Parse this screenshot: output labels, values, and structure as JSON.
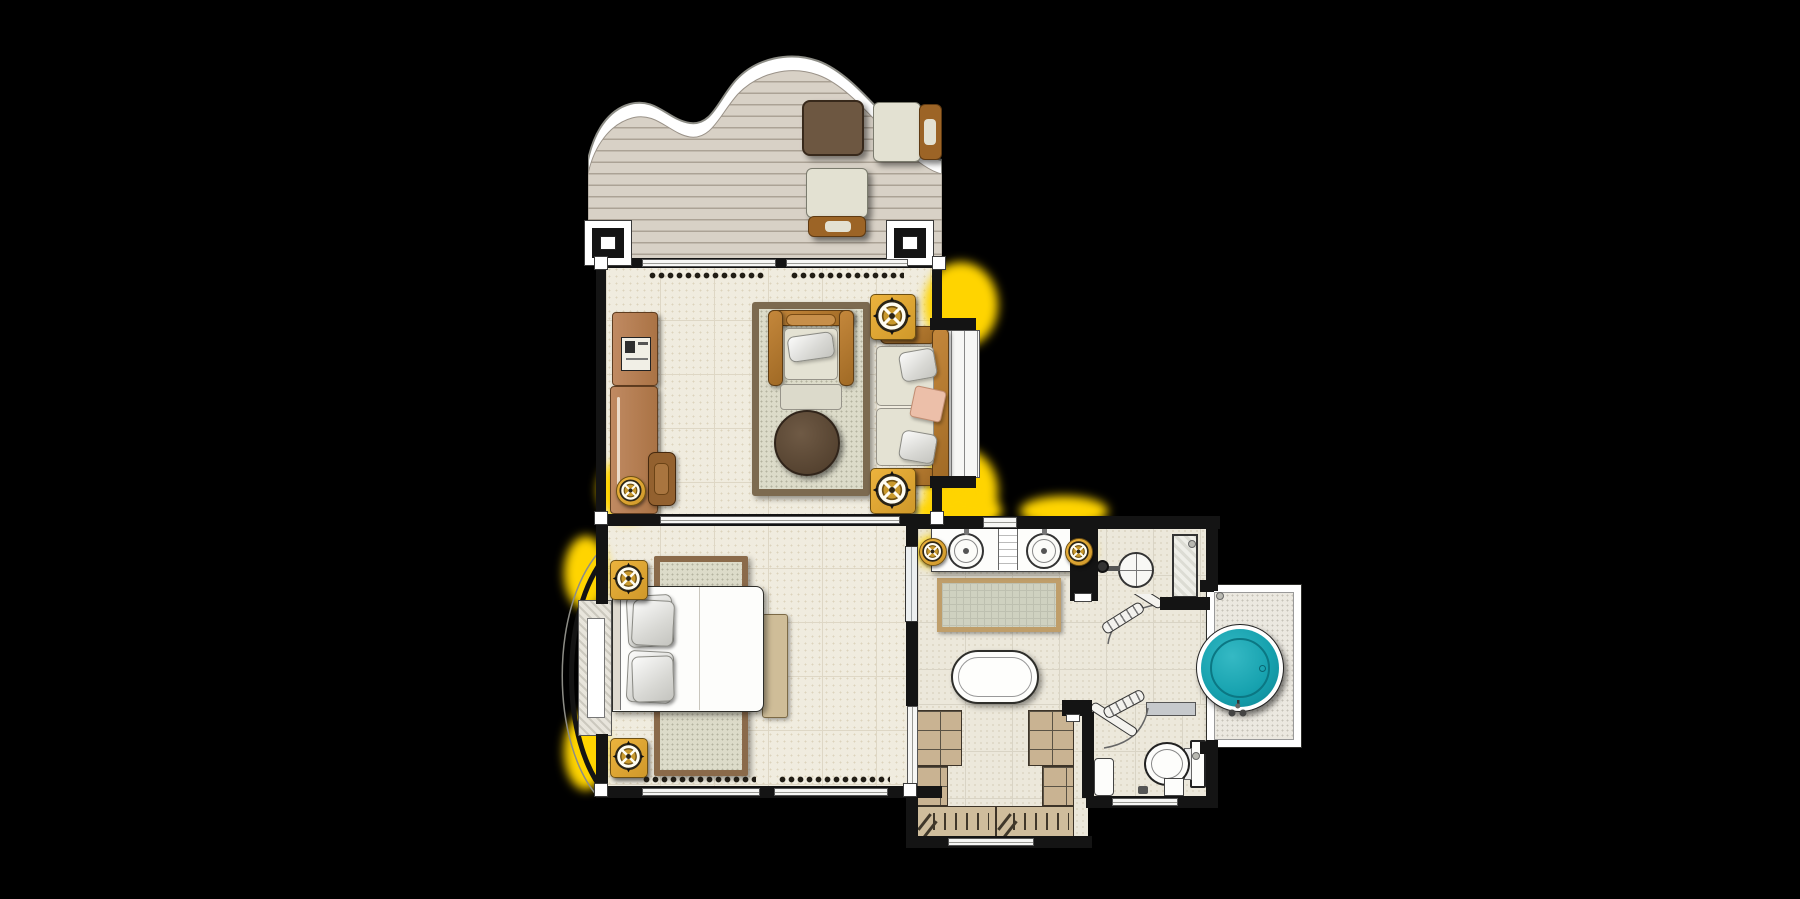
{
  "meta": {
    "kind": "floor-plan",
    "canvas": {
      "width": 1800,
      "height": 899
    }
  },
  "palette": {
    "background": "#000000",
    "wall": "#141414",
    "deck_wood": "#d8d1c6",
    "deck_line": "#aba295",
    "floor_cream": "#f0ecdf",
    "floor_bath": "#ece8db",
    "cabinet_brown": "#b5825d",
    "wood_frame": "#b0772f",
    "cushion_beige": "#e4e2d3",
    "pillow_pink": "#ecbfa9",
    "gold_accent": "#e2a930",
    "glow_yellow": "#ffd400",
    "rug_border_living": "#7c6a50",
    "rug_border_bed": "#8a6a4a",
    "rug_border_bath": "#bf9e6a",
    "coffee_table_brown": "#5f4b38",
    "wardrobe_tan": "#c9b392",
    "pool_teal": "#17a2af",
    "pool_teal_dark": "#0e8694",
    "fixture_white": "#fdfdfb"
  },
  "rooms": [
    {
      "name": "sun-deck"
    },
    {
      "name": "living-room"
    },
    {
      "name": "bedroom"
    },
    {
      "name": "bathroom"
    },
    {
      "name": "dressing-area"
    },
    {
      "name": "wc"
    },
    {
      "name": "plunge-pool-deck"
    }
  ],
  "fixtures": {
    "sun_deck": [
      "deck-table",
      "sun-lounger",
      "sun-lounger",
      "column",
      "column"
    ],
    "living_room": [
      "minibar-cabinet",
      "console-table",
      "desk-chair",
      "console-lamp",
      "area-rug",
      "armchair",
      "round-coffee-table",
      "sofa",
      "side-table-lamp",
      "side-table-lamp",
      "sliding-doors",
      "curtains",
      "bay-window"
    ],
    "bedroom": [
      "double-bed",
      "pillows",
      "bed-rug",
      "nightstand-lamp",
      "nightstand-lamp",
      "foot-bench",
      "bay-window-seat",
      "sliding-doors",
      "curtains",
      "mirror"
    ],
    "bathroom": [
      "double-vanity",
      "sink",
      "sink",
      "wall-sconce",
      "wall-sconce",
      "bath-rug",
      "freestanding-bathtub",
      "rain-shower",
      "shower-door",
      "glass-panel"
    ],
    "dressing_area": [
      "wardrobe",
      "wardrobe",
      "hanging-rail",
      "hangers"
    ],
    "wc": [
      "toilet",
      "shelf",
      "bin",
      "door"
    ],
    "pool_deck": [
      "plunge-pool",
      "pool-faucet",
      "deck-platform"
    ]
  },
  "counts": {
    "sinks": 2,
    "sun_loungers": 2,
    "lamps": 7,
    "wardrobe_units": 2
  }
}
